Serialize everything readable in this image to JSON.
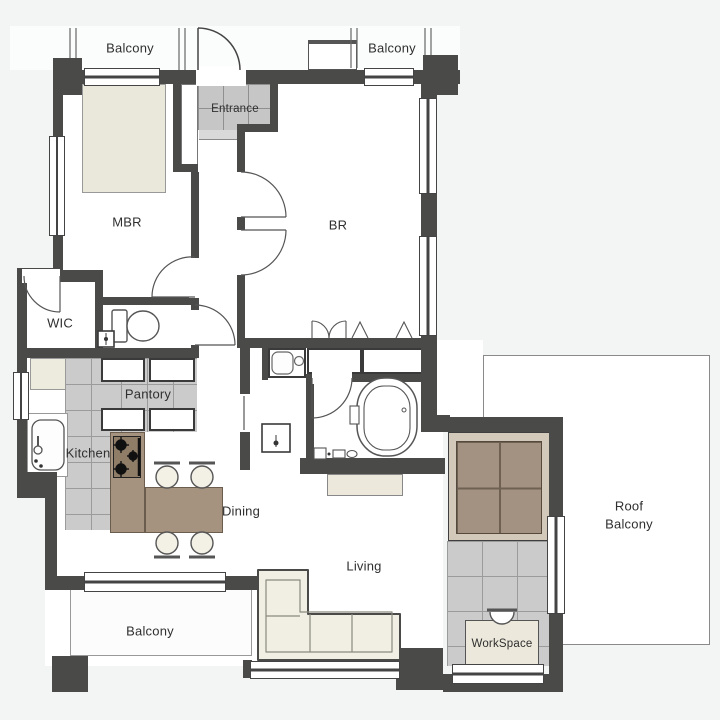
{
  "plan": {
    "title": "Apartment floor plan",
    "labels": {
      "balcony_top_left": "Balcony",
      "balcony_top_right": "Balcony",
      "entrance": "Entrance",
      "mbr": "MBR",
      "br": "BR",
      "wic": "WIC",
      "pantry": "Pantory",
      "kitchen": "Kitchen",
      "dining": "Dining",
      "living": "Living",
      "balcony_bottom": "Balcony",
      "roof_balcony_line1": "Roof",
      "roof_balcony_line2": "Balcony",
      "workspace": "WorkSpace"
    },
    "colors": {
      "background": "#f3f5f4",
      "wall": "#4a4a49",
      "tile_floor": "#cbcbcb",
      "tile_line": "#9b9b9b",
      "entrance_tile": "#c6c6c6",
      "wood_furniture": "#a5937f",
      "stove_panel": "#8f7d68",
      "tatami": "#a39181",
      "tatami_frame": "#d2c9ba",
      "furniture_beige": "#eae7db",
      "sofa": "#f1eee3",
      "fixture_outline": "#555555",
      "label_text": "#2f2f2f"
    }
  }
}
